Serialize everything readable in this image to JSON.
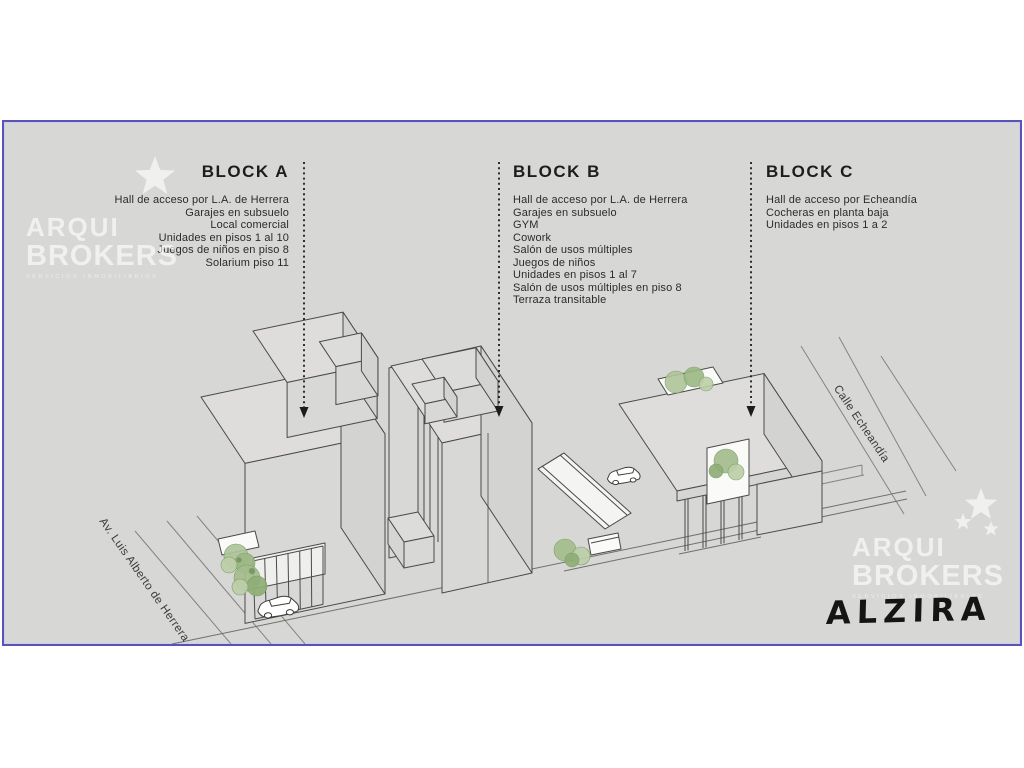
{
  "project": {
    "name": "ALZIRA"
  },
  "brand": {
    "line1": "ARQUI",
    "line2": "BROKERS",
    "tagline": "SERVICIOS INMOBILIARIOS"
  },
  "blocks": [
    {
      "title": "BLOCK A",
      "features": [
        "Hall de acceso por L.A. de Herrera",
        "Garajes en subsuelo",
        "Local comercial",
        "Unidades en pisos 1 al 10",
        "Juegos de niños en piso 8",
        "Solarium piso 11"
      ]
    },
    {
      "title": "BLOCK B",
      "features": [
        "Hall de acceso por L.A. de Herrera",
        "Garajes en subsuelo",
        "GYM",
        "Cowork",
        "Salón de usos múltiples",
        "Juegos de niños",
        "Unidades en pisos 1 al 7",
        "Salón de usos múltiples en piso 8",
        "Terraza transitable"
      ]
    },
    {
      "title": "BLOCK C",
      "features": [
        "Hall de acceso por Echeandía",
        "Cocheras en planta baja",
        "Unidades en pisos 1 a 2"
      ]
    }
  ],
  "streets": [
    {
      "name": "Av. Luis Alberto de Herrera"
    },
    {
      "name": "Calle Echeandía"
    }
  ],
  "colors": {
    "canvas_bg": "#d7d7d5",
    "border_accent": "#5a52bc",
    "drawing_line": "#4a4a48",
    "tree_green": "#a3bd8c",
    "text": "#2b2b29",
    "watermark": "rgba(255,255,255,0.6)"
  }
}
